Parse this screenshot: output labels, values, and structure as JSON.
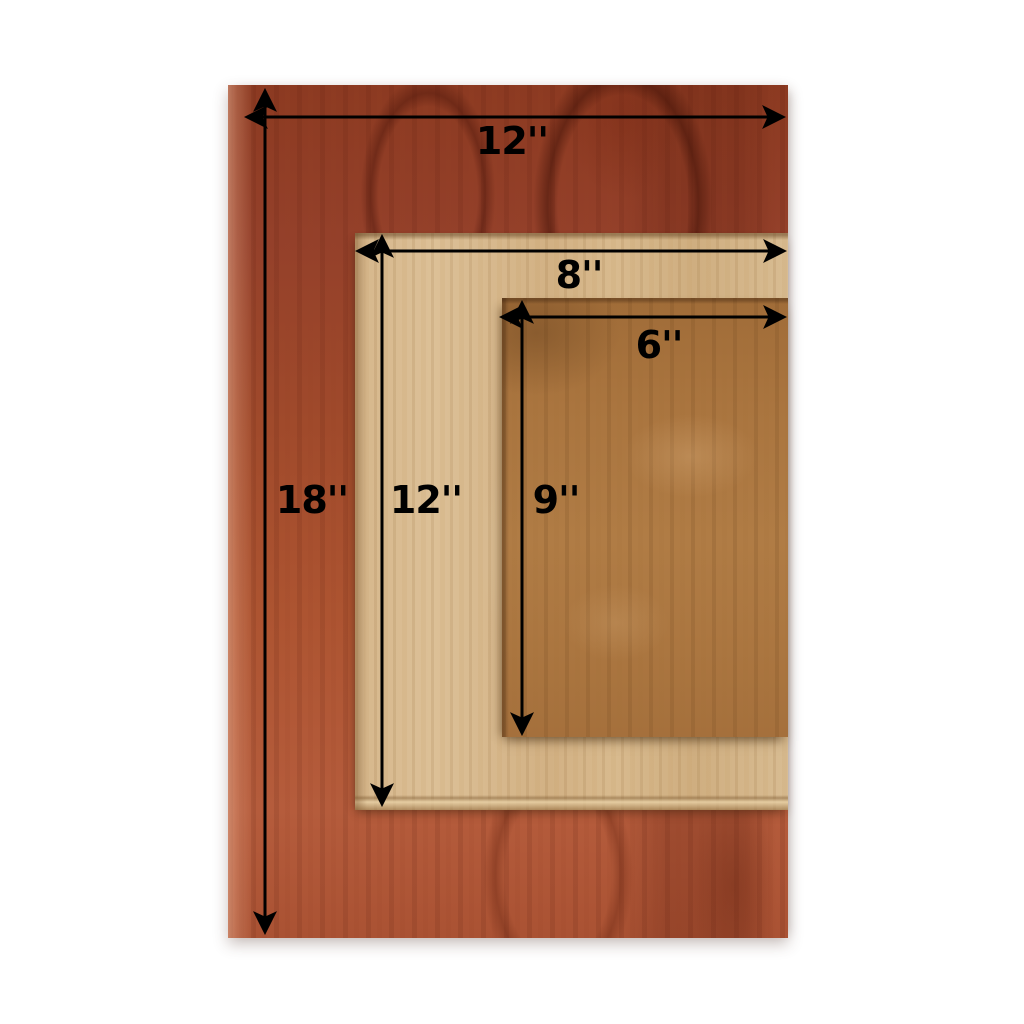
{
  "figure": {
    "type": "product-dimension-diagram",
    "subject": "Three rectangular wooden boards stacked from largest to smallest, right-aligned, with measurement arrows",
    "background_color": "#ffffff",
    "annotation_color": "#000000",
    "boards": [
      {
        "id": "large",
        "description": "reddish mahogany board",
        "width_label": "12''",
        "height_label": "18''",
        "width_in": 12,
        "height_in": 18,
        "wood_color": "#a34b2a"
      },
      {
        "id": "medium",
        "description": "light tan board",
        "width_label": "8''",
        "height_label": "12''",
        "width_in": 8,
        "height_in": 12,
        "wood_color": "#d7b98e"
      },
      {
        "id": "small",
        "description": "medium brown board",
        "width_label": "6''",
        "height_label": "9''",
        "width_in": 6,
        "height_in": 9,
        "wood_color": "#ab7641"
      }
    ]
  }
}
